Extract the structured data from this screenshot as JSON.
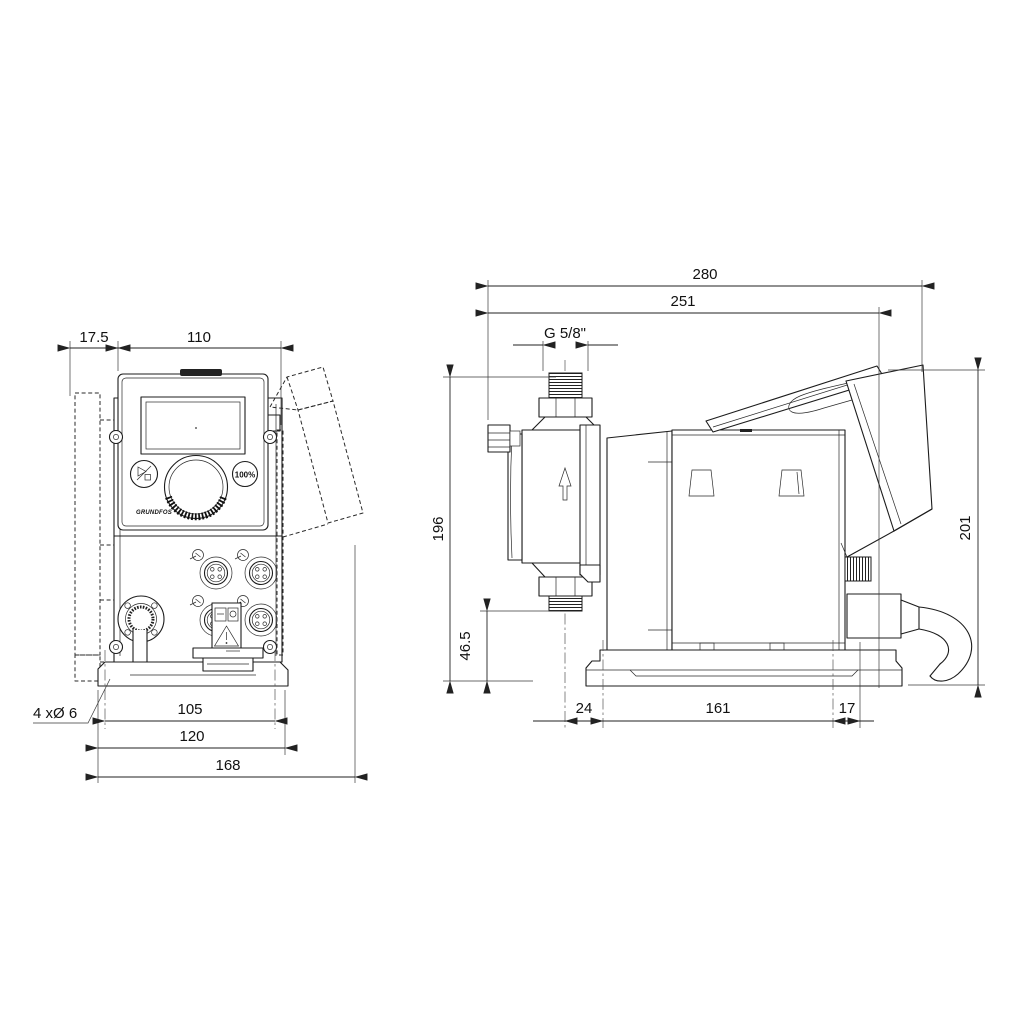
{
  "front": {
    "dim_offset": "17.5",
    "dim_width": "110",
    "dim_hole_spacing": "105",
    "dim_plate_width": "120",
    "dim_total_width": "168",
    "holes_label": "4 xØ 6",
    "btn_max": "100%",
    "logo": "GRUNDFOS"
  },
  "side": {
    "dim_total_depth": "280",
    "dim_cover_depth": "251",
    "thread_label": "G 5/8\"",
    "dim_height": "196",
    "dim_valve_height": "46.5",
    "dim_total_height": "201",
    "dim_head_offset": "24",
    "dim_hole_spacing": "161",
    "dim_rear_offset": "17"
  }
}
